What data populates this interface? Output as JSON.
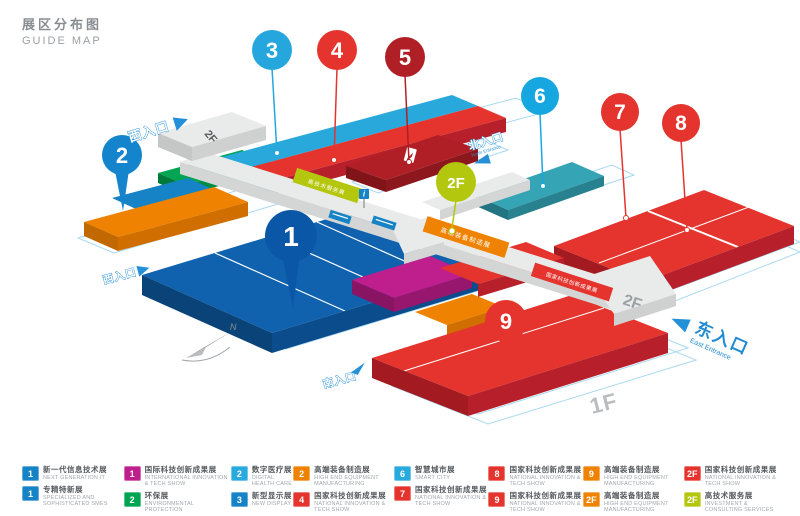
{
  "title": {
    "zh": "展区分布图",
    "en": "GUIDE MAP"
  },
  "colors": {
    "blue": "#1583c5",
    "dark_blue": "#0b57a7",
    "cyan": "#29aadf",
    "teal": "#35a4b5",
    "red": "#e5332d",
    "dark_red": "#b01f26",
    "magenta": "#bf1e8d",
    "green": "#00a551",
    "orange": "#ef8200",
    "lime": "#b5c60e",
    "entrance_blue": "#2490d8",
    "walkway_gray": "#e9ebea",
    "base_outline": "#a9d9f0"
  },
  "map": {
    "pins": [
      {
        "label": "1",
        "color": "#0b57a7"
      },
      {
        "label": "2",
        "color": "#1485cc"
      },
      {
        "label": "3",
        "color": "#25a7de"
      },
      {
        "label": "4",
        "color": "#e5332d"
      },
      {
        "label": "5",
        "color": "#b01f26"
      },
      {
        "label": "6",
        "color": "#17a7e0"
      },
      {
        "label": "7",
        "color": "#e5332d"
      },
      {
        "label": "8",
        "color": "#e5332d"
      },
      {
        "label": "9",
        "color": "#e5332d"
      },
      {
        "label": "2F",
        "color": "#b3c70f"
      }
    ],
    "entrances": {
      "west_upper": "西入口",
      "north_zh": "北入口",
      "north_en": "North Entrance",
      "east_zh": "东入口",
      "east_en": "East Entrance",
      "west_lower": "西入口",
      "south": "南入口"
    },
    "floor_labels": {
      "west_platform": "2F",
      "east_walkway": "2F",
      "ground": "1F"
    },
    "banners": {
      "lime": "高技术服务展",
      "orange": "高端装备制造展",
      "red": "国家科技创新成果展"
    },
    "compass_label": "N",
    "info_icon": "i"
  },
  "legend": {
    "items": [
      {
        "num": "1",
        "color": "#1583c5",
        "zh": "新一代信息技术展",
        "en": "NEXT GENERATION IT"
      },
      {
        "num": "1",
        "color": "#1583c5",
        "zh": "专精特新展",
        "en": "SPECIALIZED AND SOPHISTICATED SMES"
      },
      {
        "num": "1",
        "color": "#bf1e8d",
        "zh": "国际科技创新成果展",
        "en": "INTERNATIONAL INNOVATION & TECH SHOW"
      },
      {
        "num": "2",
        "color": "#00a551",
        "zh": "环保展",
        "en": "ENVIRONMENTAL PROTECTION"
      },
      {
        "num": "2",
        "color": "#29aadf",
        "zh": "数字医疗展",
        "en": "DIGITAL HEALTH CARE"
      },
      {
        "num": "3",
        "color": "#1583c5",
        "zh": "新型显示展",
        "en": "NEW DISPLAY"
      },
      {
        "num": "2",
        "color": "#ef8200",
        "zh": "高端装备制造展",
        "en": "HIGH END EQUIPMENT MANUFACTURING"
      },
      {
        "num": "4",
        "color": "#e5332d",
        "zh": "国家科技创新成果展",
        "en": "NATIONAL INNOVATION & TECH SHOW"
      },
      {
        "num": "6",
        "color": "#29aadf",
        "zh": "智慧城市展",
        "en": "SMART CITY"
      },
      {
        "num": "7",
        "color": "#e5332d",
        "zh": "国家科技创新成果展",
        "en": "NATIONAL INNOVATION & TECH SHOW"
      },
      {
        "num": "8",
        "color": "#e5332d",
        "zh": "国家科技创新成果展",
        "en": "NATIONAL INNOVATION & TECH SHOW"
      },
      {
        "num": "9",
        "color": "#e5332d",
        "zh": "国家科技创新成果展",
        "en": "NATIONAL INNOVATION & TECH SHOW"
      },
      {
        "num": "9",
        "color": "#ef8200",
        "zh": "高端装备制造展",
        "en": "HIGH END EQUIPMENT MANUFACTURING"
      },
      {
        "num": "2F",
        "color": "#ef8200",
        "zh": "高端装备制造展",
        "en": "HIGH END EQUIPMENT MANUFACTURING"
      },
      {
        "num": "2F",
        "color": "#e5332d",
        "zh": "国家科技创新成果展",
        "en": "NATIONAL INNOVATION & TECH SHOW"
      },
      {
        "num": "2F",
        "color": "#b5c60e",
        "zh": "高技术服务展",
        "en": "INVESTMENT & CONSULTING SERVICES"
      }
    ]
  }
}
